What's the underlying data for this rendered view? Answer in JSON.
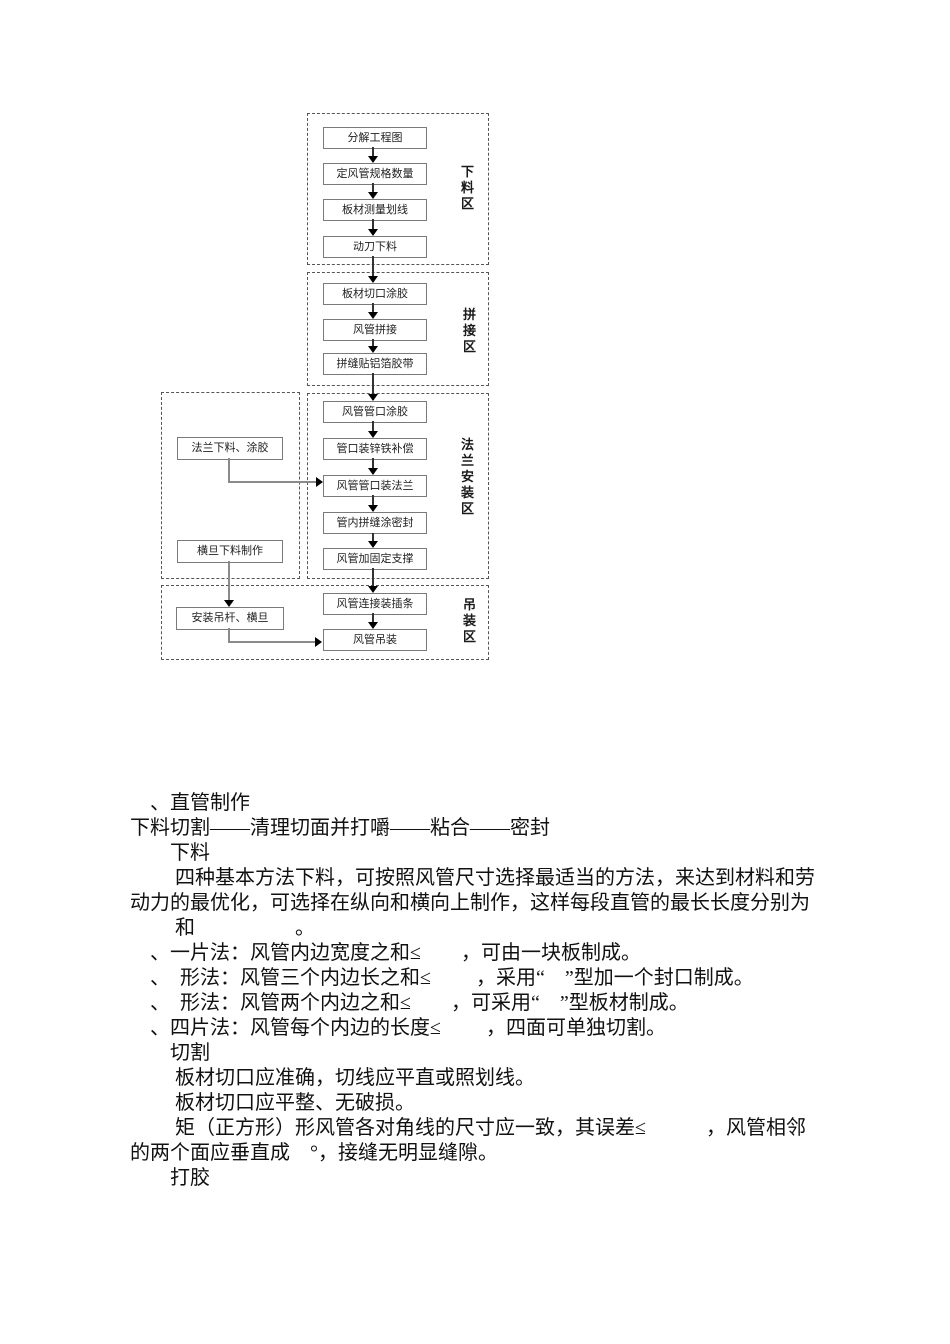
{
  "flowchart": {
    "zones": [
      {
        "label": "下料区"
      },
      {
        "label": "拼接区"
      },
      {
        "label": "法兰安装区"
      },
      {
        "label": "吊装区"
      }
    ],
    "main_steps": [
      "分解工程图",
      "定风管规格数量",
      "板材测量划线",
      "动刀下料",
      "板材切口涂胶",
      "风管拼接",
      "拼缝贴铝箔胶带",
      "风管管口涂胶",
      "管口装锌铁补偿",
      "风管管口装法兰",
      "管内拼缝涂密封",
      "风管加固定支撑",
      "风管连接装插条",
      "风管吊装"
    ],
    "side_steps": [
      "法兰下料、涂胶",
      "横旦下料制作",
      "安装吊杆、横旦"
    ]
  },
  "body": {
    "lines": [
      "　、直管制作",
      "下料切割——清理切面并打嚼——粘合——密封",
      "　　下料",
      "　　 四种基本方法下料，可按照风管尺寸选择最适当的方法，来达到材料和劳",
      "动力的最优化，可选择在纵向和横向上制作，这样每段直管的最长长度分别为",
      "　　 和　　　　　。",
      "　、一片法：风管内边宽度之和≤　　，可由一块板制成。",
      "　、　形法：风管三个内边长之和≤　　 ，采用“　”型加一个封口制成。",
      "　、　形法：风管两个内边之和≤　　，可采用“　”型板材制成。",
      "　、四片法：风管每个内边的长度≤　　 ，四面可单独切割。",
      "　　切割",
      "　　 板材切口应准确，切线应平直或照划线。",
      "　　 板材切口应平整、无破损。",
      "　　 矩（正方形）形风管各对角线的尺寸应一致，其误差≤　　　，风管相邻",
      "的两个面应垂直成　°，接缝无明显缝隙。",
      "　　打胶"
    ]
  },
  "colors": {
    "box_border": "#7a7a7a",
    "zone_border": "#555555",
    "arrow": "#333333",
    "connector": "#8a8a8a",
    "text": "#111111"
  }
}
